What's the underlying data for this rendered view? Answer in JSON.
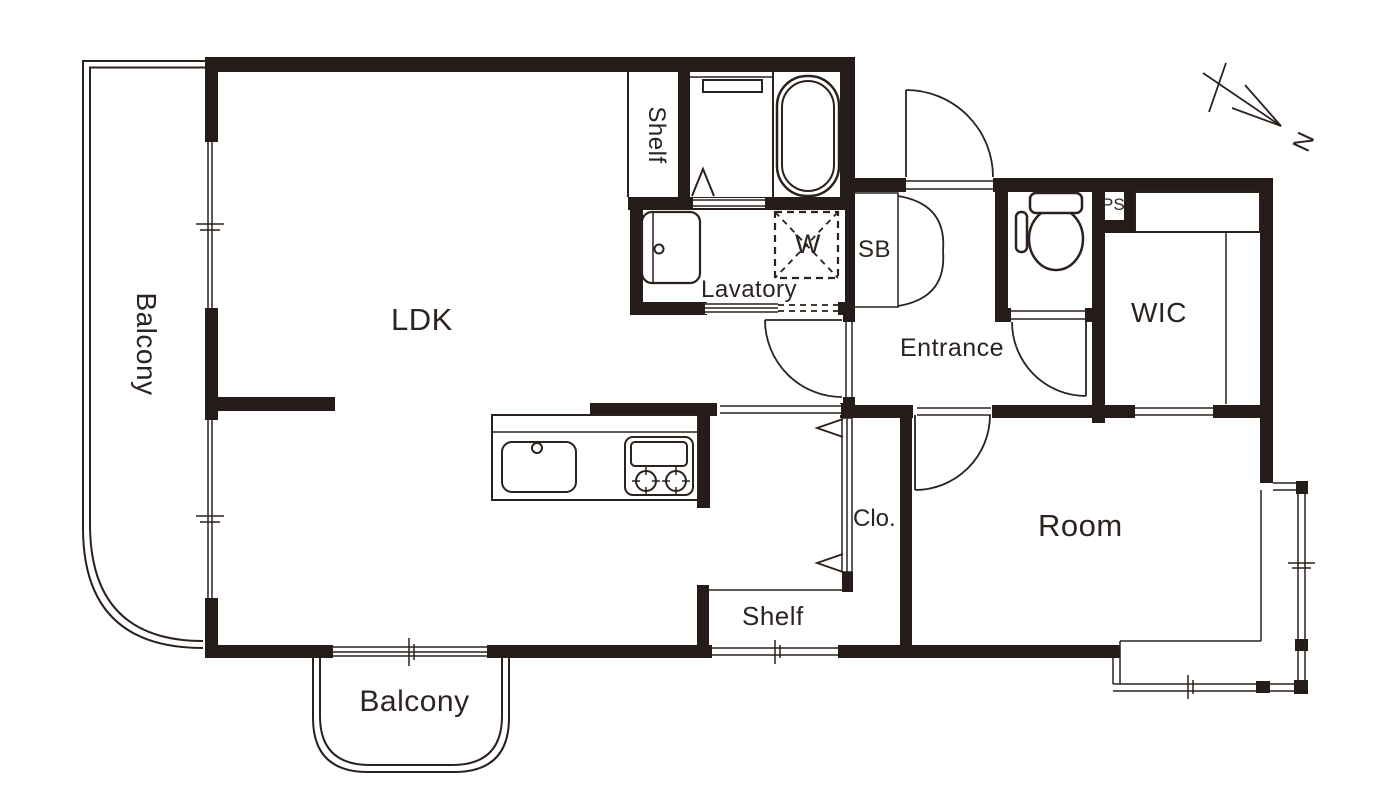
{
  "title": "Apartment floor plan",
  "colors": {
    "wall": "#251b18",
    "line": "#2b211d",
    "text": "#2b2420",
    "bg": "#ffffff"
  },
  "rooms": {
    "ldk": "LDK",
    "room": "Room",
    "wic": "WIC",
    "entrance": "Entrance",
    "lavatory": "Lavatory",
    "closet": "Clo.",
    "balcony_left": "Balcony",
    "balcony_bottom": "Balcony"
  },
  "storage": {
    "shelf_top": "Shelf",
    "shelf_bottom": "Shelf",
    "shoe_box": "SB",
    "pipe_space": "PS"
  },
  "fixtures": {
    "washer": "W"
  },
  "compass": {
    "north": "N"
  }
}
